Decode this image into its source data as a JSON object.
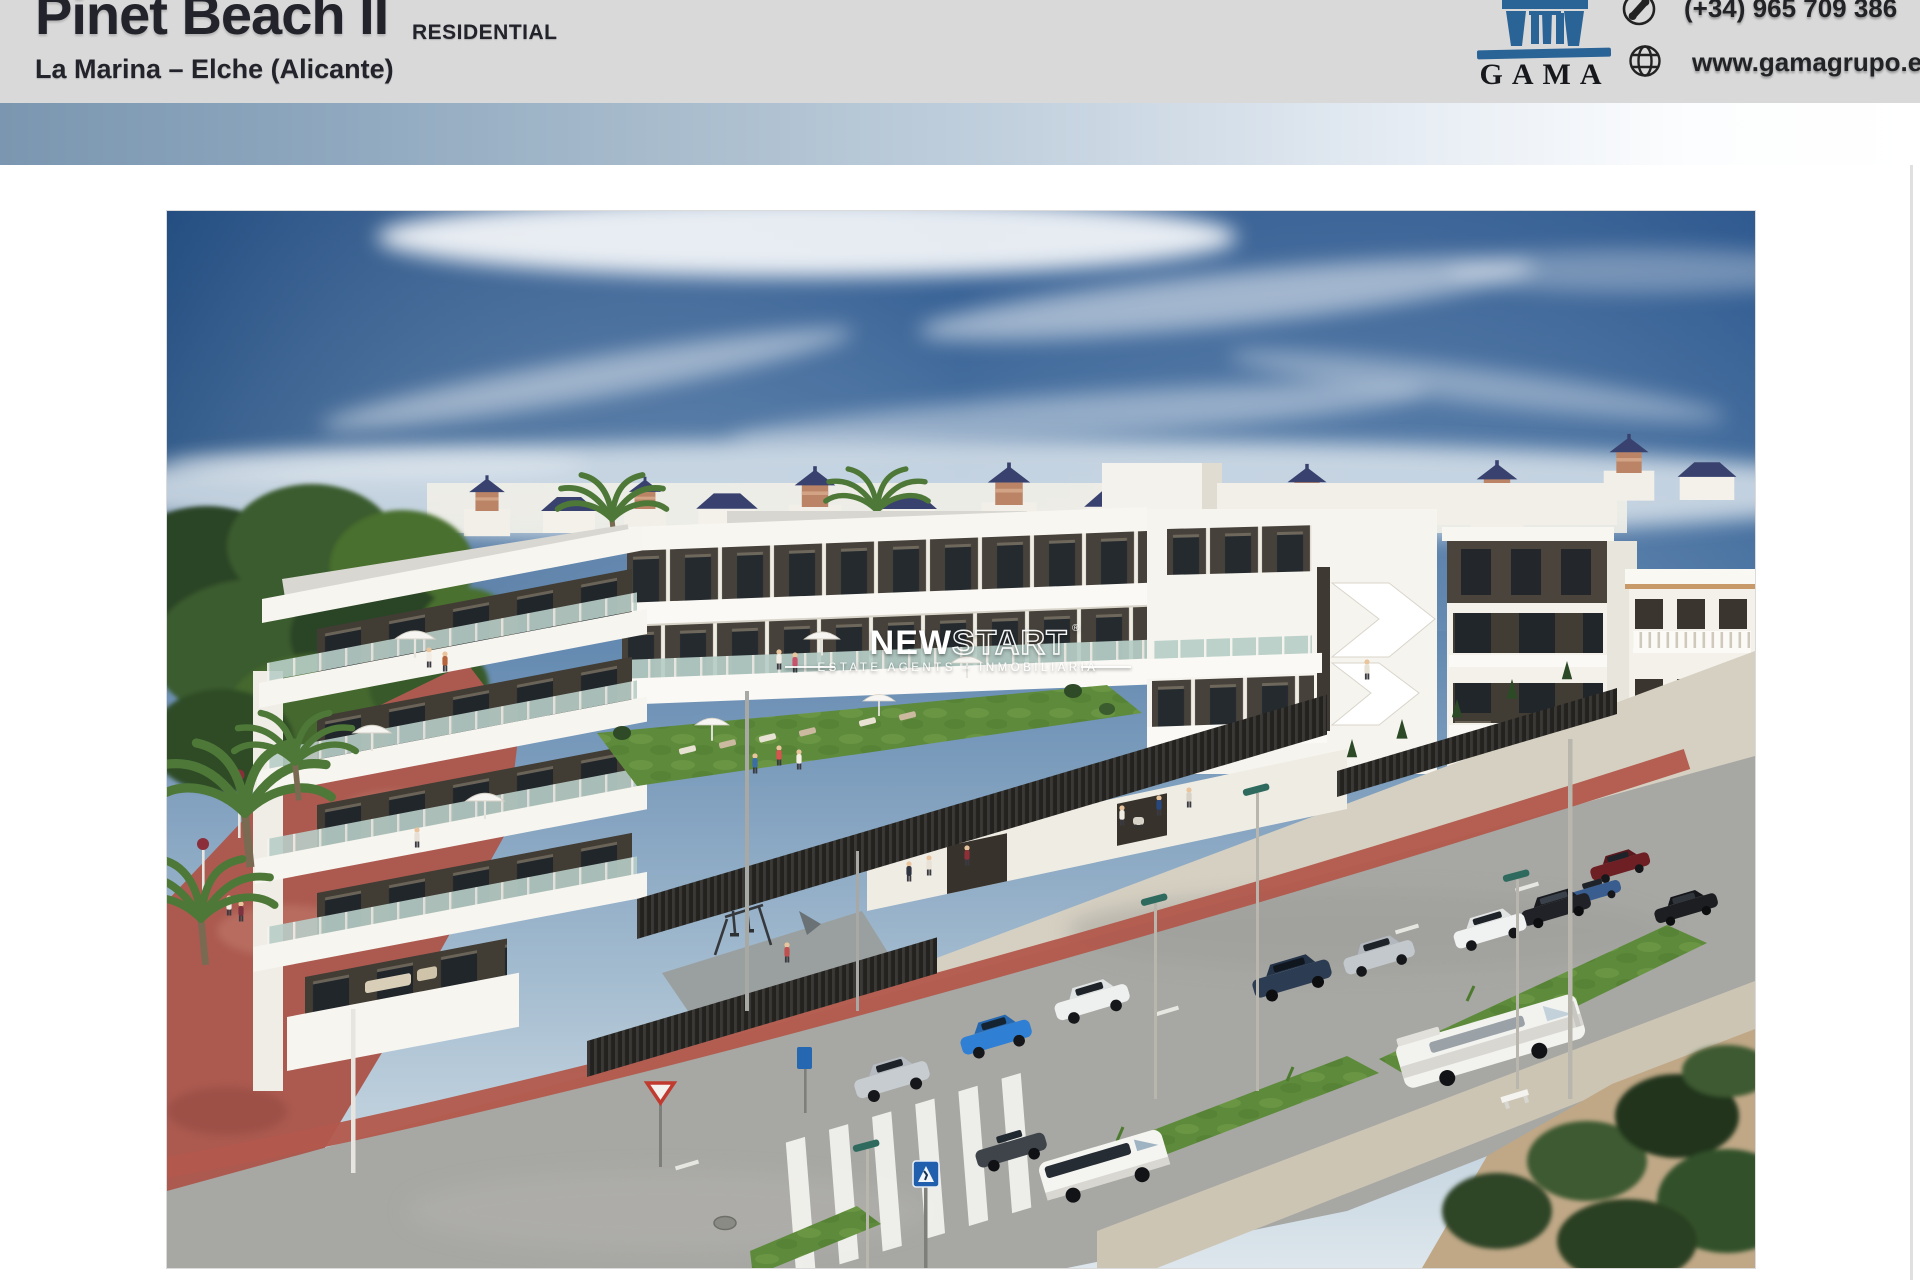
{
  "header": {
    "title": "Pinet Beach II",
    "title_suffix": "RESIDENTIAL",
    "subtitle": "La Marina – Elche (Alicante)",
    "brand": "GAMA",
    "phone": "(+34) 965 709 386",
    "website": "www.gamagrupo.es"
  },
  "watermark": {
    "brand_solid": "NEW",
    "brand_outline": "START",
    "registered": "®",
    "tagline": "ESTATE AGENTS – INMOBILIARIA"
  },
  "colors": {
    "brand_blue": "#2a6395",
    "header_bg": "#d9d9da",
    "accent_bar_start": "#7b96b0",
    "accent_bar_end": "#ffffff",
    "sky_blue": "#2f5a90",
    "villa_roof_navy": "#39426e",
    "building_white": "#f7f5f0",
    "building_dark_wall": "#48423a",
    "promenade_red": "#ac5a50",
    "bike_lane_red": "#b2584c",
    "lamp_head_green": "#2e6b5e"
  }
}
